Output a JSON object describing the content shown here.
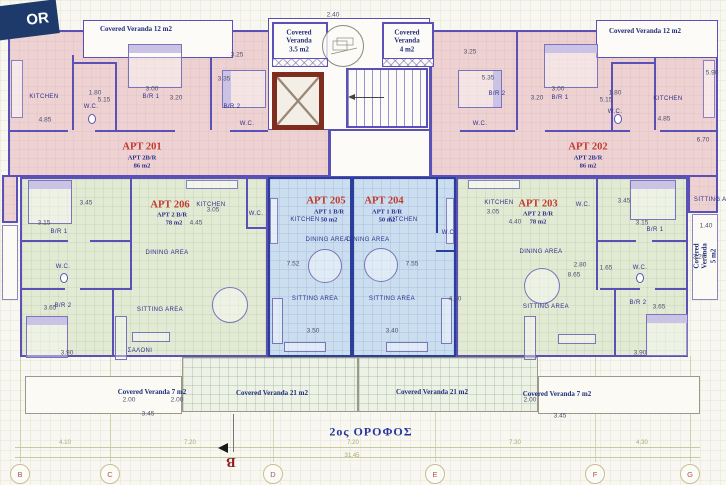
{
  "floor_tag": "OR",
  "title": "2ος ΟΡΟΦΟΣ",
  "colors": {
    "apartment_pink": "#eed2d2",
    "apartment_green": "#e3ead4",
    "apartment_blue": "#cadeef",
    "wall_purple": "#5b50b5",
    "wall_blue": "#2b3e9c",
    "elevator_red": "#7e2d1f",
    "apt_label_red": "#c23a2e",
    "label_navy": "#2e2e8c",
    "banner_navy": "#1d3a6b"
  },
  "apartments": [
    {
      "name": "APT 201",
      "type": "APT 2B/R",
      "area": "86 m2"
    },
    {
      "name": "APT 202",
      "type": "APT 2B/R",
      "area": "86 m2"
    },
    {
      "name": "APT 203",
      "type": "APT 2 B/R",
      "area": "78 m2"
    },
    {
      "name": "APT 204",
      "type": "APT 1 B/R",
      "area": "50 m2"
    },
    {
      "name": "APT 205",
      "type": "APT 1 B/R",
      "area": "50 m2"
    },
    {
      "name": "APT 206",
      "type": "APT 2 B/R",
      "area": "78 m2"
    }
  ],
  "veranda_labels": [
    {
      "t": "Covered Veranda 12  m2",
      "x": 136,
      "y": 29
    },
    {
      "t": "Covered\nVeranda\n3.5 m2",
      "x": 299,
      "y": 41
    },
    {
      "t": "Covered\nVeranda\n4 m2",
      "x": 407,
      "y": 41
    },
    {
      "t": "Covered Veranda 12 m2",
      "x": 645,
      "y": 31
    },
    {
      "t": "Covered Veranda 5 m2",
      "x": 705,
      "y": 256,
      "v": true
    },
    {
      "t": "Covered Veranda 7 m2",
      "x": 152,
      "y": 392
    },
    {
      "t": "Covered Veranda 21 m2",
      "x": 272,
      "y": 393
    },
    {
      "t": "Covered Veranda 21 m2",
      "x": 432,
      "y": 392
    },
    {
      "t": "Covered Veranda 7 m2",
      "x": 557,
      "y": 394
    }
  ],
  "room_labels": [
    {
      "t": "KITCHEN",
      "x": 44,
      "y": 97
    },
    {
      "t": "W.C.",
      "x": 91,
      "y": 107
    },
    {
      "t": "B/R 1",
      "x": 151,
      "y": 97
    },
    {
      "t": "B/R 2",
      "x": 232,
      "y": 107
    },
    {
      "t": "W.C.",
      "x": 247,
      "y": 124
    },
    {
      "t": "KITCHEN",
      "x": 668,
      "y": 99
    },
    {
      "t": "W.C.",
      "x": 615,
      "y": 112
    },
    {
      "t": "B/R 1",
      "x": 560,
      "y": 98
    },
    {
      "t": "B/R 2",
      "x": 497,
      "y": 94
    },
    {
      "t": "W.C.",
      "x": 480,
      "y": 124
    },
    {
      "t": "SITTING AREA",
      "x": 717,
      "y": 200
    },
    {
      "t": "KITCHEN",
      "x": 211,
      "y": 205
    },
    {
      "t": "DINING AREA",
      "x": 167,
      "y": 253
    },
    {
      "t": "W.C.",
      "x": 63,
      "y": 267
    },
    {
      "t": "B/R 1",
      "x": 59,
      "y": 232
    },
    {
      "t": "B/R 2",
      "x": 63,
      "y": 306
    },
    {
      "t": "SITTING AREA",
      "x": 160,
      "y": 310
    },
    {
      "t": "ΣΑΛΟΝΙ",
      "x": 140,
      "y": 351
    },
    {
      "t": "W.C.",
      "x": 256,
      "y": 214
    },
    {
      "t": "KITCHEN",
      "x": 305,
      "y": 220
    },
    {
      "t": "DINING AREA",
      "x": 327,
      "y": 240
    },
    {
      "t": "SITTING AREA",
      "x": 315,
      "y": 299
    },
    {
      "t": "KITCHEN",
      "x": 403,
      "y": 220
    },
    {
      "t": "DINING AREA",
      "x": 368,
      "y": 240
    },
    {
      "t": "SITTING AREA",
      "x": 392,
      "y": 299
    },
    {
      "t": "W.C.",
      "x": 449,
      "y": 233
    },
    {
      "t": "KITCHEN",
      "x": 499,
      "y": 203
    },
    {
      "t": "DINING AREA",
      "x": 541,
      "y": 252
    },
    {
      "t": "SITTING AREA",
      "x": 546,
      "y": 307
    },
    {
      "t": "W.C.",
      "x": 583,
      "y": 205
    },
    {
      "t": "W.C.",
      "x": 640,
      "y": 268
    },
    {
      "t": "B/R 1",
      "x": 655,
      "y": 230
    },
    {
      "t": "B/R 2",
      "x": 638,
      "y": 303
    }
  ],
  "dim_labels": [
    {
      "t": "3.25",
      "x": 237,
      "y": 55
    },
    {
      "t": "3.35",
      "x": 224,
      "y": 79
    },
    {
      "t": "3.00",
      "x": 152,
      "y": 89
    },
    {
      "t": "3.20",
      "x": 176,
      "y": 98
    },
    {
      "t": "1.80",
      "x": 95,
      "y": 93
    },
    {
      "t": "5.15",
      "x": 104,
      "y": 100
    },
    {
      "t": "4.85",
      "x": 45,
      "y": 120
    },
    {
      "t": "3.25",
      "x": 470,
      "y": 52
    },
    {
      "t": "5.35",
      "x": 488,
      "y": 78
    },
    {
      "t": "3.00",
      "x": 558,
      "y": 89
    },
    {
      "t": "3.20",
      "x": 537,
      "y": 98
    },
    {
      "t": "1.80",
      "x": 615,
      "y": 93
    },
    {
      "t": "5.15",
      "x": 606,
      "y": 100
    },
    {
      "t": "4.85",
      "x": 664,
      "y": 119
    },
    {
      "t": "5.90",
      "x": 712,
      "y": 73
    },
    {
      "t": "6.70",
      "x": 703,
      "y": 140
    },
    {
      "t": "2.40",
      "x": 333,
      "y": 15
    },
    {
      "t": "3.45",
      "x": 86,
      "y": 203
    },
    {
      "t": "3.15",
      "x": 44,
      "y": 223
    },
    {
      "t": "3.65",
      "x": 50,
      "y": 308
    },
    {
      "t": "3.90",
      "x": 67,
      "y": 353
    },
    {
      "t": "3.05",
      "x": 213,
      "y": 210
    },
    {
      "t": "4.45",
      "x": 196,
      "y": 223
    },
    {
      "t": "7.52",
      "x": 293,
      "y": 264
    },
    {
      "t": "3.50",
      "x": 313,
      "y": 331
    },
    {
      "t": "7.55",
      "x": 412,
      "y": 264
    },
    {
      "t": "3.40",
      "x": 392,
      "y": 331
    },
    {
      "t": "4.40",
      "x": 455,
      "y": 299
    },
    {
      "t": "3.05",
      "x": 493,
      "y": 212
    },
    {
      "t": "4.40",
      "x": 515,
      "y": 222
    },
    {
      "t": "3.45",
      "x": 624,
      "y": 201
    },
    {
      "t": "3.15",
      "x": 642,
      "y": 223
    },
    {
      "t": "2.80",
      "x": 580,
      "y": 265
    },
    {
      "t": "1.65",
      "x": 606,
      "y": 268
    },
    {
      "t": "8.65",
      "x": 574,
      "y": 275
    },
    {
      "t": "3.65",
      "x": 659,
      "y": 307
    },
    {
      "t": "3.90",
      "x": 640,
      "y": 353
    },
    {
      "t": "1.40",
      "x": 706,
      "y": 226
    },
    {
      "t": "3.20",
      "x": 699,
      "y": 257
    },
    {
      "t": "2.00",
      "x": 129,
      "y": 400
    },
    {
      "t": "2.00",
      "x": 177,
      "y": 400
    },
    {
      "t": "3.45",
      "x": 148,
      "y": 414
    },
    {
      "t": "2.00",
      "x": 530,
      "y": 400
    },
    {
      "t": "3.45",
      "x": 560,
      "y": 416
    }
  ],
  "grid": {
    "letters": [
      {
        "t": "B",
        "x": 20
      },
      {
        "t": "C",
        "x": 110
      },
      {
        "t": "D",
        "x": 273
      },
      {
        "t": "E",
        "x": 435
      },
      {
        "t": "F",
        "x": 595
      },
      {
        "t": "G",
        "x": 690
      }
    ],
    "dims": [
      {
        "t": "4.10",
        "x": 65
      },
      {
        "t": "7.20",
        "x": 190
      },
      {
        "t": "7.20",
        "x": 353
      },
      {
        "t": "7.30",
        "x": 515
      },
      {
        "t": "4.30",
        "x": 642
      }
    ],
    "overall": {
      "t": "31.45",
      "x": 352
    }
  },
  "section_marker": "B"
}
